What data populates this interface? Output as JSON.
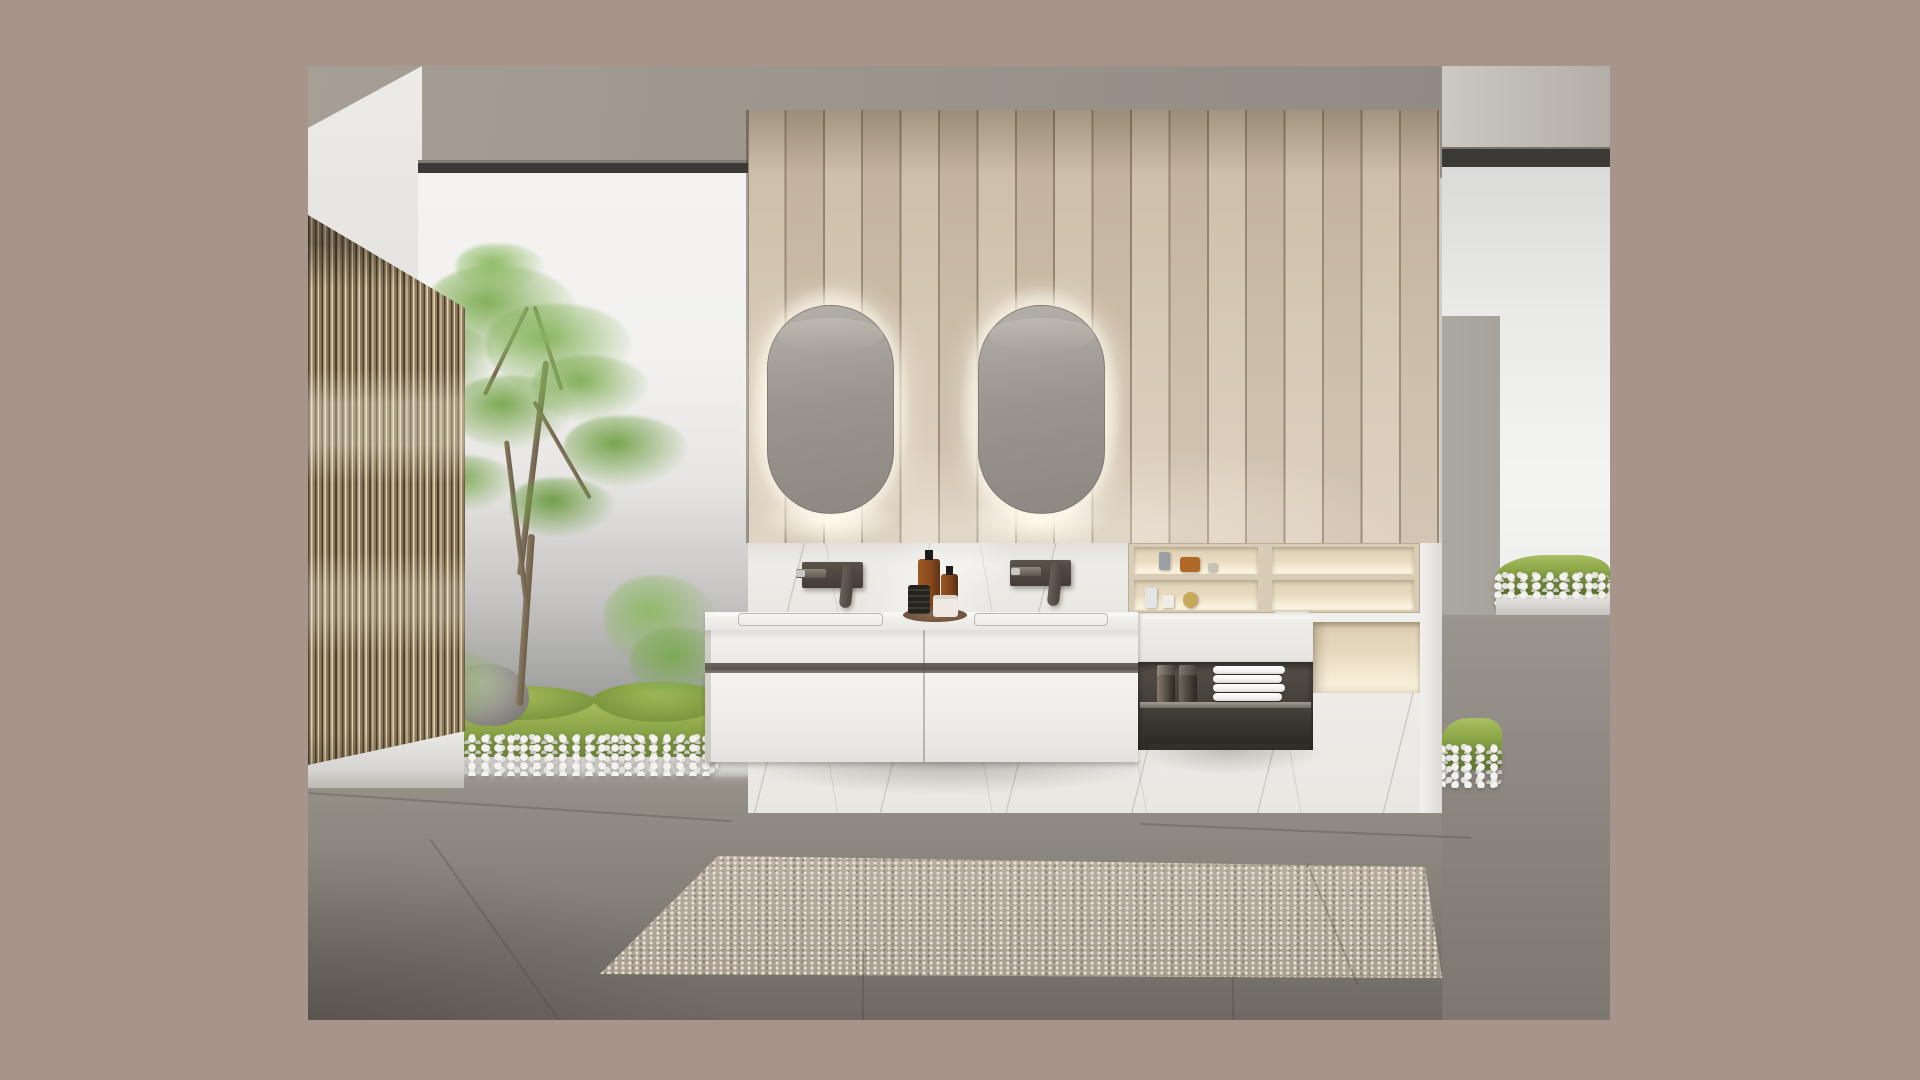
{
  "meta": {
    "title": "Minimalist bathroom interior render",
    "description": "Photorealistic render of a modern bathroom: wood-slat partition screen on the left, indoor courtyard garden with bamboo tree, moss and white pebbles, central oak-plank feature wall with two backlit pill-shaped mirrors, floating white double vanity with dark bronze wall-mounted faucets, wooden display niches with perfume bottles, open bronze shelf with folded towels, marble plinth, gray tile floor and a textured beige rug, all framed by a taupe matte border."
  },
  "colors": {
    "frame": "#a7948a",
    "ceiling1": "#a69f96",
    "ceiling2": "#8f8881",
    "wallWhite1": "#edebe7",
    "wallWhite2": "#cfcdc9",
    "windowBar": "#3c3a36",
    "glassL1": "#f2f1ef",
    "glassL2": "#9d9d9b",
    "glassR1": "#dadad8",
    "glassR2": "#f4f4f2",
    "wood1": "#c8b8a0",
    "wood2": "#d6c8b4",
    "marble": "#e9e7e2",
    "nicheWood": "#d9ccb6",
    "vanity": "#f2f0ec",
    "groove": "#57524b",
    "bronze1": "#575049",
    "bronze2": "#322e29",
    "towel": "#f0efec",
    "mossA": "#93ad4e",
    "mossB": "#61792c",
    "pebble": "#f3f2ef",
    "floor1": "#949087",
    "floor2": "#6e6962",
    "rug": "#b1a89a",
    "mirror1": "#aaa49e",
    "mirror2": "#8e8882",
    "slatHi": "#e2d3b0",
    "slatMid": "#8d7a5c",
    "slatDark": "#4a4136",
    "amber": "#8a4a1e",
    "trayBrown": "#6e4f3a",
    "rock": "#9a9792",
    "curb": "#d9d7d3",
    "grayPillar": "#a6a29c"
  },
  "counts": {
    "mirrors": 2,
    "faucets": 2,
    "towels": 4,
    "screen_slats": 23,
    "wood_planks": 18,
    "vanity_drawers": 2,
    "niche_rows": 2
  },
  "scene": {
    "tree": {
      "clusters": [
        {
          "x": 118,
          "y": 200,
          "w": 152,
          "h": 94,
          "c": "#7fae54"
        },
        {
          "x": 64,
          "y": 256,
          "w": 126,
          "h": 86,
          "c": "#6f9f46"
        },
        {
          "x": 178,
          "y": 238,
          "w": 148,
          "h": 90,
          "c": "#86b45c"
        },
        {
          "x": 144,
          "y": 310,
          "w": 124,
          "h": 74,
          "c": "#79a74f"
        },
        {
          "x": 50,
          "y": 320,
          "w": 106,
          "h": 68,
          "c": "#6b9a43"
        },
        {
          "x": 224,
          "y": 290,
          "w": 118,
          "h": 66,
          "c": "#81af57"
        },
        {
          "x": 256,
          "y": 350,
          "w": 126,
          "h": 72,
          "c": "#74a24a"
        },
        {
          "x": 202,
          "y": 412,
          "w": 106,
          "h": 60,
          "c": "#6d9c44"
        },
        {
          "x": 110,
          "y": 390,
          "w": 98,
          "h": 56,
          "c": "#7aa850"
        },
        {
          "x": 148,
          "y": 178,
          "w": 90,
          "h": 50,
          "c": "#8cba62"
        },
        {
          "x": 296,
          "y": 510,
          "w": 114,
          "h": 94,
          "c": "#8fb968"
        },
        {
          "x": 322,
          "y": 562,
          "w": 106,
          "h": 74,
          "c": "#7daa55"
        },
        {
          "x": 4,
          "y": 532,
          "w": 134,
          "h": 94,
          "c": "#a3c47e"
        },
        {
          "x": 52,
          "y": 582,
          "w": 154,
          "h": 86,
          "c": "#8fb463"
        },
        {
          "x": -8,
          "y": 604,
          "w": 118,
          "h": 74,
          "c": "#7ea94f"
        }
      ],
      "branches": [
        {
          "x": 222,
          "y": 294,
          "w": 6,
          "h": 216,
          "r": 7
        },
        {
          "x": 214,
          "y": 468,
          "w": 7,
          "h": 172,
          "r": 4
        },
        {
          "x": 206,
          "y": 374,
          "w": 5,
          "h": 166,
          "r": -7
        },
        {
          "x": 196,
          "y": 236,
          "w": 4,
          "h": 98,
          "r": 26
        },
        {
          "x": 238,
          "y": 238,
          "w": 4,
          "h": 88,
          "r": -18
        },
        {
          "x": 252,
          "y": 328,
          "w": 4,
          "h": 112,
          "r": -30
        }
      ]
    },
    "niche_items": [
      {
        "name": "gray-bottle",
        "x": 851,
        "y": 486,
        "w": 11,
        "h": 18,
        "c": "#9aa0a4",
        "r": "2px"
      },
      {
        "name": "amber-perfume",
        "x": 872,
        "y": 491,
        "w": 20,
        "h": 15,
        "c": "#b06a28",
        "r": "3px"
      },
      {
        "name": "small-bottle",
        "x": 900,
        "y": 497,
        "w": 9,
        "h": 9,
        "c": "#c8c2b4",
        "r": "2px"
      },
      {
        "name": "clear-bottle",
        "x": 837,
        "y": 522,
        "w": 12,
        "h": 20,
        "c": "#e3e6e6",
        "r": "2px"
      },
      {
        "name": "cube-perfume",
        "x": 854,
        "y": 529,
        "w": 12,
        "h": 13,
        "c": "#f0ede6",
        "r": "2px"
      },
      {
        "name": "gold-perfume",
        "x": 875,
        "y": 526,
        "w": 15,
        "h": 16,
        "c": "#c8a85a",
        "r": "50%"
      }
    ],
    "perfume_boxes": [
      {
        "name": "perfume-box",
        "x": 849,
        "y": 599,
        "w": 18,
        "h": 37,
        "c": "#857c6e"
      },
      {
        "name": "perfume-box",
        "x": 871,
        "y": 599,
        "w": 18,
        "h": 37,
        "c": "#6e665c"
      }
    ],
    "floor_seams": [
      {
        "x": 0,
        "y": 726,
        "w": 425,
        "rot": 3.8
      },
      {
        "x": 832,
        "y": 757,
        "w": 332,
        "rot": 2.4
      },
      {
        "x": 555,
        "y": 884,
        "w": 70,
        "rot": 90
      },
      {
        "x": 925,
        "y": 909,
        "w": 45,
        "rot": 90
      },
      {
        "x": 122,
        "y": 772,
        "w": 224,
        "rot": 54.5
      },
      {
        "x": 999,
        "y": 796,
        "w": 132,
        "rot": 67.4
      }
    ],
    "towel_stack": {
      "x": 905,
      "y": 600,
      "towel_w": 72,
      "towel_h": 8,
      "gap": 1
    }
  }
}
